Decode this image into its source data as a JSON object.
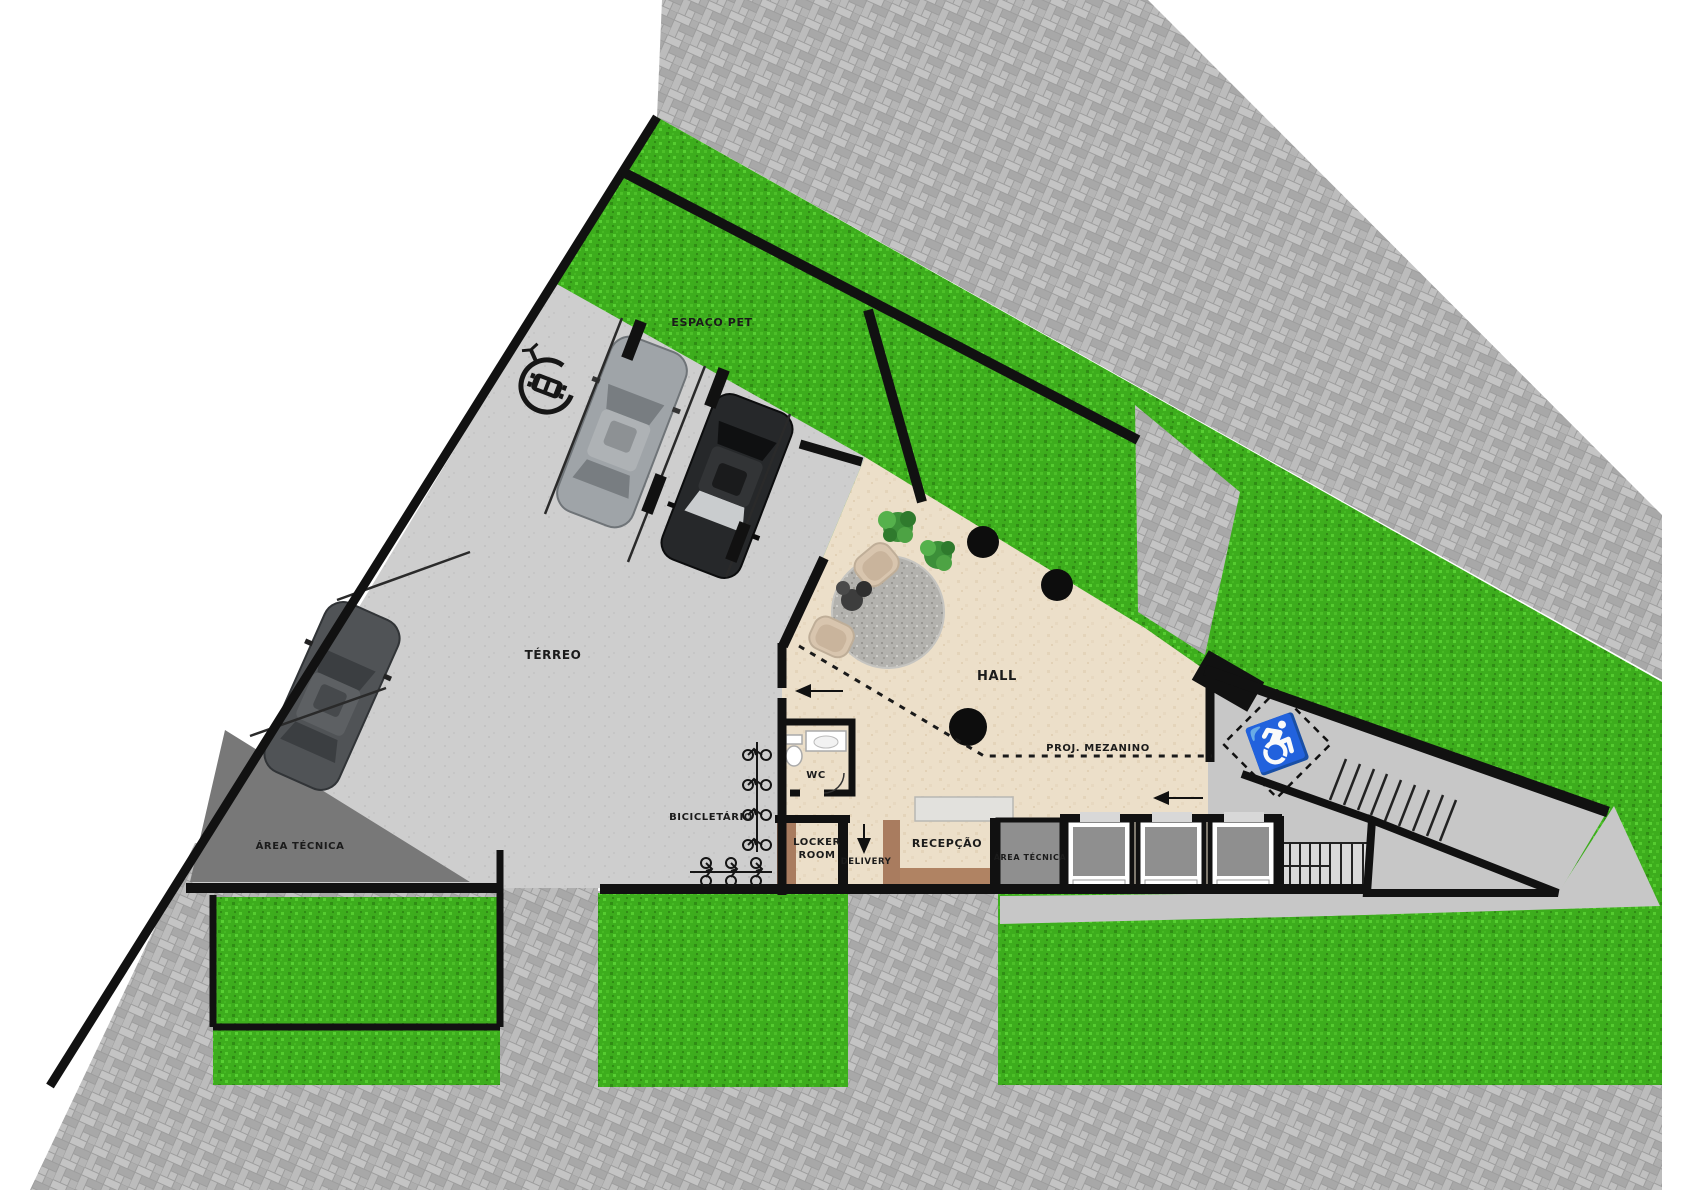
{
  "title": "Ground floor site plan",
  "labels": {
    "terreo": "TÉRREO",
    "hall": "HALL",
    "espaco_pet": "ESPAÇO PET",
    "wc": "WC",
    "bicicletario": "BICICLETÁRIO",
    "locker_room_line1": "LOCKER",
    "locker_room_line2": "ROOM",
    "delivery": "DELIVERY",
    "recepcao": "RECEPÇÃO",
    "area_tecnica_left": "ÁREA TÉCNICA",
    "area_tecnica_right": "ÁREA TÉCNICA",
    "proj_mezanino": "PROJ. MEZANINO"
  },
  "icons": {
    "wheelchair_glyph": "♿",
    "names": [
      "ev-charging-icon",
      "wheelchair-accessible-icon",
      "bike-rack-icon"
    ]
  },
  "colors": {
    "grass": "#3dad1d",
    "paver_sidewalk": "#b5b5b5",
    "concrete_parking": "#cecece",
    "hall_floor": "#ecdfc9",
    "wall": "#111111",
    "wood": "#a97c5f",
    "wood_floor": "#b08363",
    "technical_area_dark": "#787878",
    "technical_area_room": "#8f8f8f",
    "marble_counter": "#e2e1dd",
    "gravel_rug": "#b3b2ae",
    "stair_tread": "#d9d9d9",
    "building_slab": "#c7c7c7"
  }
}
